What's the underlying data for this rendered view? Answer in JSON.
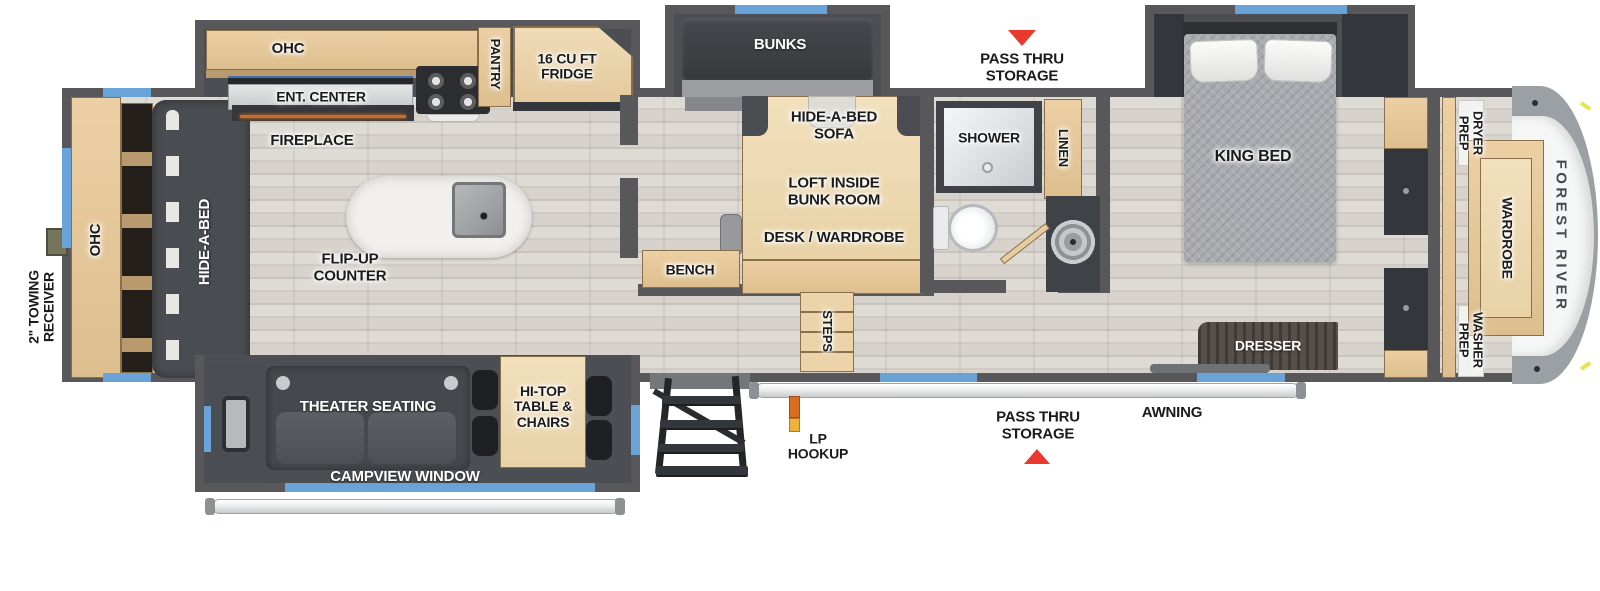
{
  "floorplan": {
    "brand": "FOREST RIVER",
    "labels": {
      "towing_receiver": "2\" TOWING RECEIVER",
      "ohc_rear": "OHC",
      "hide_a_bed": "HIDE-A-BED",
      "ohc_kitchen": "OHC",
      "ent_center": "ENT. CENTER",
      "fireplace": "FIREPLACE",
      "pantry": "PANTRY",
      "fridge": "16 CU FT FRIDGE",
      "flip_up_counter": "FLIP-UP COUNTER",
      "bunks": "BUNKS",
      "pass_thru_storage_top": "PASS THRU STORAGE",
      "hide_a_bed_sofa": "HIDE-A-BED SOFA",
      "loft_inside_bunk_room": "LOFT INSIDE BUNK ROOM",
      "desk_wardrobe": "DESK / WARDROBE",
      "bench": "BENCH",
      "steps": "STEPS",
      "shower": "SHOWER",
      "linen": "LINEN",
      "king_bed": "KING BED",
      "dresser": "DRESSER",
      "dryer_prep": "DRYER PREP",
      "wardrobe": "WARDROBE",
      "washer_prep": "WASHER PREP",
      "theater_seating": "THEATER SEATING",
      "hi_top_table": "HI-TOP TABLE & CHAIRS",
      "campview_window": "CAMPVIEW WINDOW",
      "lp_hookup": "LP HOOKUP",
      "pass_thru_storage_bottom": "PASS THRU STORAGE",
      "awning": "AWNING"
    },
    "colors": {
      "wall": "#58585a",
      "wood_cabinet": "#e8cfa5",
      "window_blue": "#6aa3d8",
      "indicator_red": "#e8392f",
      "lp_orange": "#e07a1f",
      "furniture_dark": "#46494e",
      "floor_light": "#d8d4ce"
    }
  }
}
